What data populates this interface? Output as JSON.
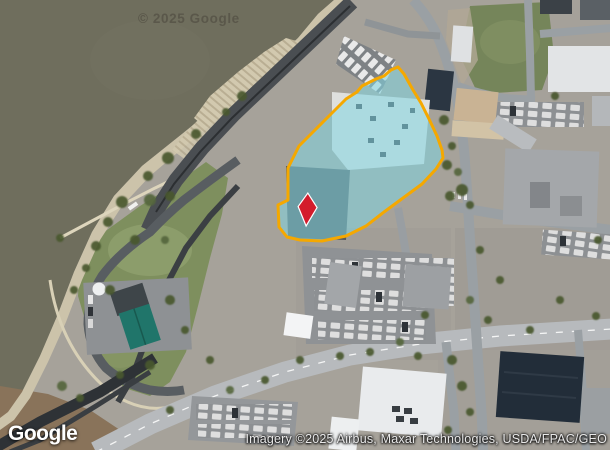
{
  "map": {
    "watermark_text": "© 2025 Google",
    "google_logo_text": "Google",
    "attribution_text": "Imagery ©2025 Airbus, Maxar Technologies, USDA/FPAC/GEO"
  },
  "overlay": {
    "parcel_fill_color": "#7fd6e2",
    "parcel_stroke_color": "#f5a800",
    "marker_fill_color": "#d31c2c",
    "marker_stroke_color": "#ffffff"
  }
}
